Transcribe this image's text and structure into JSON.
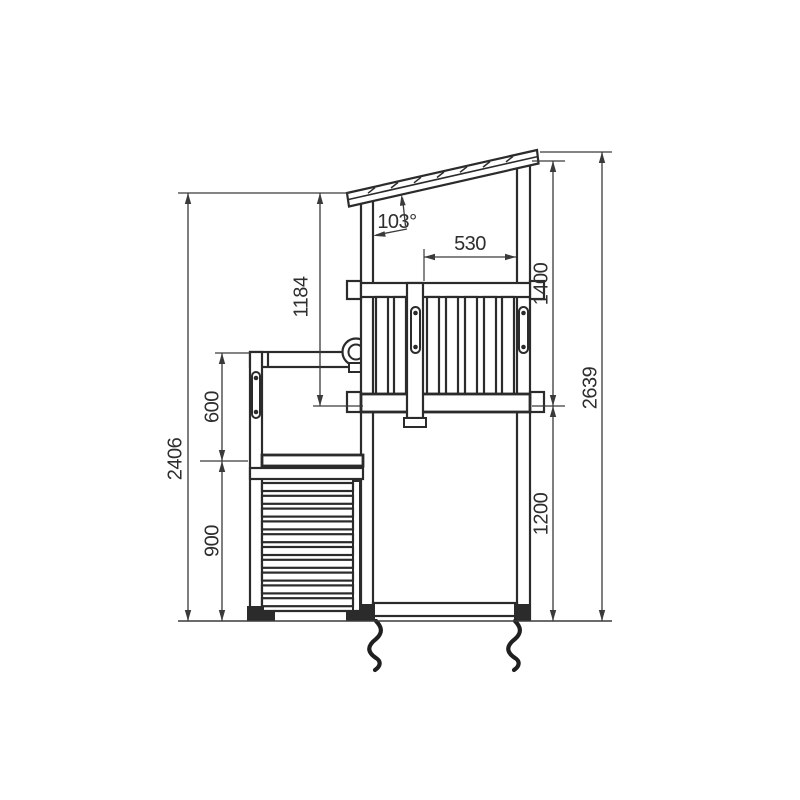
{
  "drawing": {
    "type": "technical-side-elevation-playtower",
    "background_color": "#ffffff",
    "line_color": "#2b2b2b",
    "dimensions": {
      "overall_height_left": "2406",
      "lower_rail_height": "600",
      "ramp_section_height": "900",
      "roof_to_platform_left": "1184",
      "roof_angle": "103°",
      "opening_width": "530",
      "roof_to_platform_right": "1400",
      "platform_height": "1200",
      "overall_height_right": "2639"
    }
  }
}
